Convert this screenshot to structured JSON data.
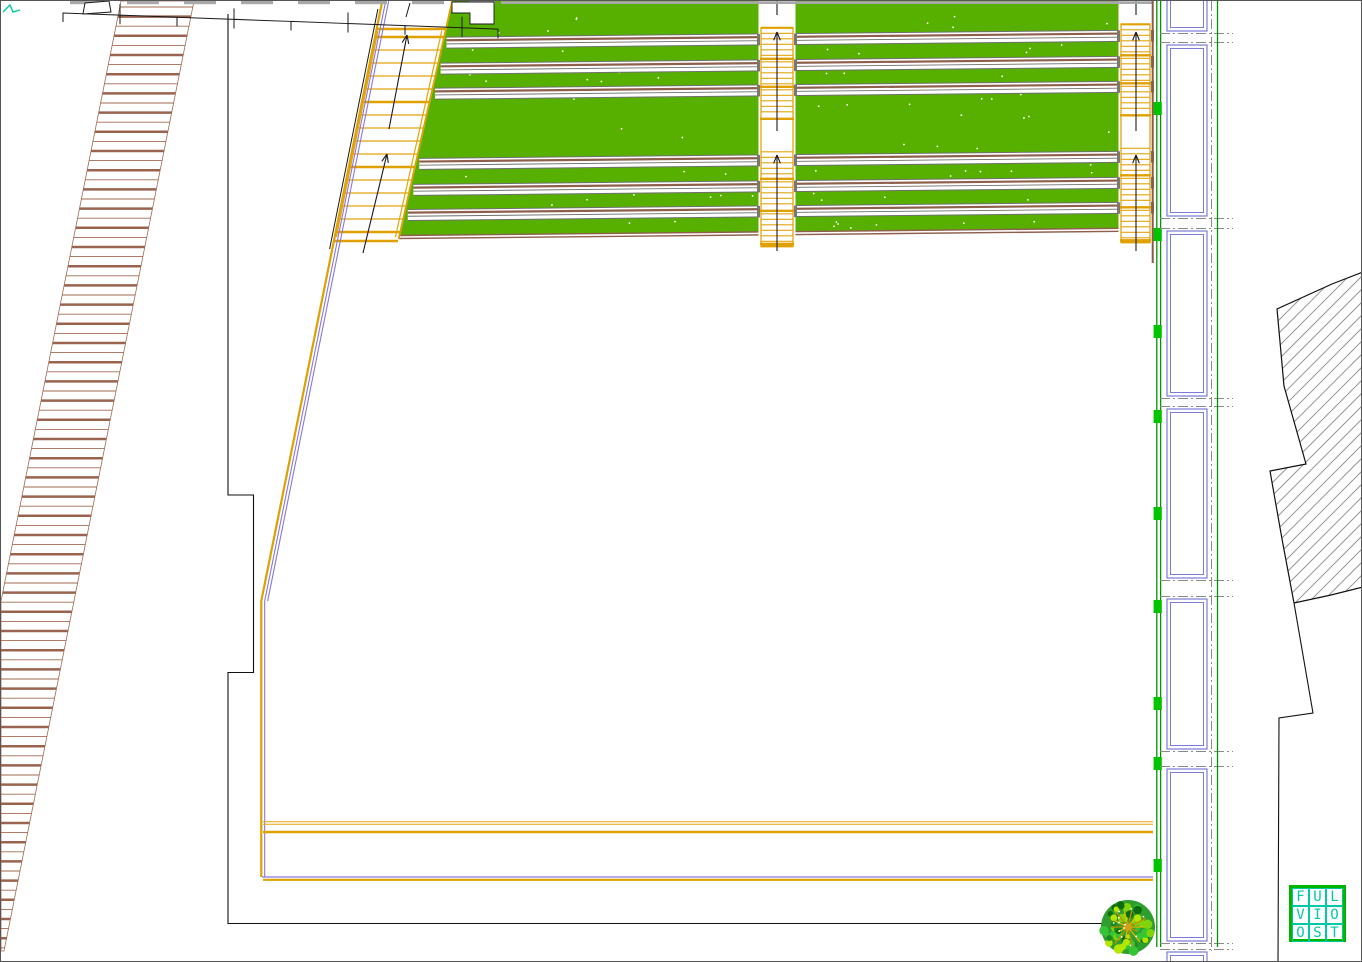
{
  "document": {
    "type": "CAD landscape site plan",
    "description": "Plan drawing with terraced lawn, stairs, access ramp, panel colonnade and hatched building section"
  },
  "logo": {
    "cells": [
      "F",
      "U",
      "L",
      "V",
      "I",
      "O",
      "O",
      "S",
      "T"
    ],
    "frame_color": "#00B400",
    "letter_color": "#00CBA4"
  },
  "colors": {
    "yellow": "#E2A410",
    "yellow_thick": "#DFA000",
    "purple": "#8877DD",
    "black": "#1A1A1A",
    "white": "#FFFFFF"
  },
  "drawing": {
    "width": 1362,
    "height": 962,
    "ramp": {
      "poly": [
        [
          120,
          0
        ],
        [
          193,
          0
        ],
        [
          3,
          950
        ],
        [
          0,
          950
        ],
        [
          0,
          600
        ]
      ],
      "tread_y0": 6,
      "tread_step": 9.6,
      "color": "#A26A52",
      "thick_color": "#9A6350"
    },
    "teeth": {
      "x0": 62,
      "x_end": 497,
      "cell_w": 57,
      "base_y": 12,
      "slope": 0.037,
      "cap_color": "#A8A8A8",
      "top_rect": [
        [
          82,
          13
        ],
        [
          84,
          2
        ],
        [
          108,
          0
        ],
        [
          110,
          11
        ]
      ],
      "notch": [
        [
          451,
          1
        ],
        [
          493,
          1
        ],
        [
          493,
          23
        ],
        [
          469,
          23
        ],
        [
          469,
          12
        ],
        [
          451,
          12
        ]
      ],
      "gray_line": {
        "x0": 500,
        "x1": 1152,
        "y": 1.6
      }
    },
    "terrace": {
      "green": "#57B000",
      "poly": [
        [
          450,
          0
        ],
        [
          1152,
          0
        ],
        [
          1152,
          227
        ],
        [
          398,
          234.5
        ]
      ],
      "slope": 0.01,
      "left_edge": {
        "x0": 452,
        "k": 0.225
      },
      "right_x": 1152,
      "strips_y": [
        29,
        55,
        80,
        150,
        176,
        201
      ],
      "strip_h": 11,
      "strip_gray": "#6F6F6F",
      "strip_brown": "#8F5F4D",
      "bottom_y": 227,
      "dot_bands": [
        [
          3,
          26
        ],
        [
          41,
          52
        ],
        [
          66,
          77
        ],
        [
          92,
          147
        ],
        [
          162,
          173
        ],
        [
          187,
          198
        ],
        [
          213,
          224
        ]
      ],
      "dot_count": 78
    },
    "stair_left": {
      "edge_x0": 378.5,
      "edge_k": 0.2017,
      "right_x0": 452,
      "right_k": 0.225,
      "tread_y0": 36,
      "tread_y1": 234,
      "tread_step": 13,
      "thick_ys": [
        28,
        36,
        101,
        166,
        231,
        240
      ],
      "black": [
        376.9,
        8,
        328.6,
        248
      ],
      "offsets": {
        "yellow": 2.8,
        "purple1": 6.2,
        "purple2": 9.2
      },
      "arrows": [
        [
          406,
          34,
          388,
          128
        ],
        [
          386,
          153,
          362,
          252
        ]
      ]
    },
    "boundary": {
      "diag_y1": 600,
      "v_y1": 876,
      "h_purple_y": 876,
      "h_yellow_y": 878.8,
      "h_x0": 261,
      "h_x1": 1152,
      "paths": {
        "pair_y": [
          820.8,
          823.2
        ],
        "thick_y": 831,
        "x0": 262,
        "x1": 1152
      }
    },
    "outline_left": {
      "path": "M 227 13 V 494 H 252.5 V 671.5 H 227 V 922.5 H 1151.5"
    },
    "channels": [
      {
        "x0": 757.5,
        "x1": 794.5,
        "dy": 3.8,
        "bottom": 248,
        "arrows": [
          [
            776,
            31,
            776,
            130
          ],
          [
            776,
            154,
            776,
            250
          ]
        ],
        "top_tick": 776
      },
      {
        "x0": 1117.5,
        "x1": 1151.5,
        "dy": 0.3,
        "bottom": 244,
        "arrows": [
          [
            1135,
            31,
            1135,
            130
          ],
          [
            1135,
            154,
            1135,
            250
          ]
        ],
        "top_tick": 1135
      }
    ],
    "flight_bands": [
      [
        23,
        52
      ],
      [
        57,
        80
      ],
      [
        85,
        112
      ],
      [
        147,
        172
      ],
      [
        177,
        204
      ],
      [
        209,
        237
      ]
    ],
    "tread_spacing": 5.5,
    "right_assembly": {
      "brown_x": 1151.7,
      "brown_y1": 262,
      "brown_color": "#8A5A45",
      "green_xs": [
        1155.8,
        1159.6
      ],
      "green_y1": 946,
      "green_line": "#009500",
      "block_color": "#00C400",
      "blocks_y": [
        101,
        227,
        324,
        409,
        506,
        599,
        696,
        756,
        858
      ],
      "block": {
        "x": 1152.6,
        "w": 8.2,
        "h": 13
      },
      "panel_x0": 1166,
      "panel_x1": 1206,
      "panel_inset": 3.5,
      "panel_color": "#7B7BD8",
      "panels": [
        [
          -8,
          30
        ],
        [
          44,
          215
        ],
        [
          230,
          395
        ],
        [
          408,
          577
        ],
        [
          598,
          748
        ],
        [
          768,
          940
        ],
        [
          951,
          975
        ]
      ],
      "dash_color": "#8A8A8A",
      "dash_x": [
        1159,
        1232
      ],
      "vdash_x": 1210.5,
      "vdash_y": [
        0,
        950
      ],
      "right_green_x": 1216.5,
      "right_green_y": [
        0,
        946
      ]
    },
    "hatch": {
      "poly": [
        [
          1362,
          271
        ],
        [
          1331,
          283
        ],
        [
          1276,
          308
        ],
        [
          1283,
          385
        ],
        [
          1305,
          463
        ],
        [
          1269,
          470
        ],
        [
          1281,
          538
        ],
        [
          1293,
          602
        ],
        [
          1330,
          594
        ],
        [
          1362,
          586
        ]
      ],
      "spacing": 13,
      "color": "#999999",
      "lower_outline": "M 1293 602 L 1312 712 L 1278 717 L 1277.5 840 L 1277 962"
    },
    "tree": {
      "cx": 1127,
      "cy": 926,
      "r": 27,
      "canopy": [
        "#1E8A1E",
        "#35C435",
        "#7FD40A",
        "#B4E600",
        "#0F6B0F"
      ],
      "core": "#D4A017"
    }
  }
}
